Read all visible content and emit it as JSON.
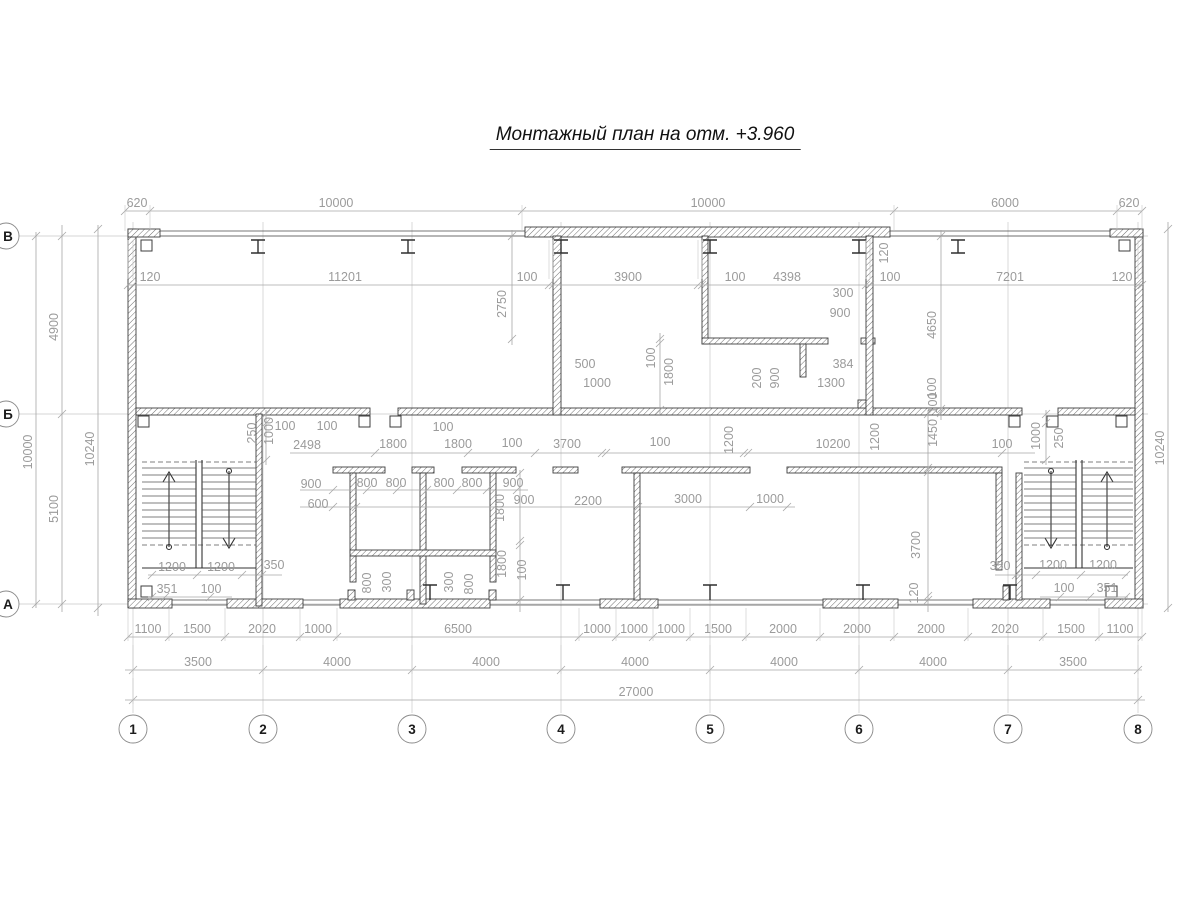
{
  "title": "Монтажный план на отм. +3.960",
  "colors": {
    "wall_line": "#3d3d3d",
    "dimension": "#9b9b9b",
    "grid": "#c9c9c9",
    "background": "#ffffff",
    "title_text": "#111111"
  },
  "axes": {
    "cols": [
      {
        "label": "1",
        "x": 133
      },
      {
        "label": "2",
        "x": 263
      },
      {
        "label": "3",
        "x": 412
      },
      {
        "label": "4",
        "x": 561
      },
      {
        "label": "5",
        "x": 710
      },
      {
        "label": "6",
        "x": 859
      },
      {
        "label": "7",
        "x": 1008
      },
      {
        "label": "8",
        "x": 1138
      }
    ],
    "rows": [
      {
        "label": "В",
        "y": 236
      },
      {
        "label": "Б",
        "y": 414
      },
      {
        "label": "А",
        "y": 604
      }
    ],
    "col_bubble_y": 729,
    "row_bubble_x": 6
  },
  "dim_chains": [
    {
      "o": "h",
      "y": 211,
      "x1": 125,
      "x2": 1142,
      "ticks": [
        125,
        150,
        522,
        894,
        1117,
        1142
      ],
      "g": [
        205,
        231
      ],
      "labels": [
        [
          "620",
          137
        ],
        [
          "10000",
          336
        ],
        [
          "10000",
          708
        ],
        [
          "6000",
          1005
        ],
        [
          "620",
          1129
        ]
      ]
    },
    {
      "o": "h",
      "y": 285,
      "x1": 128,
      "x2": 1142,
      "ticks": [
        128,
        133,
        549,
        553,
        698,
        702,
        866,
        870,
        1138,
        1142
      ],
      "g": [
        279,
        240
      ],
      "labels": [
        [
          "120",
          150
        ],
        [
          "11201",
          345
        ],
        [
          "100",
          527
        ],
        [
          "3900",
          628
        ],
        [
          "100",
          735
        ],
        [
          "4398",
          787
        ],
        [
          "100",
          890
        ],
        [
          "7201",
          1010
        ],
        [
          "120",
          1122
        ]
      ]
    },
    {
      "o": "h",
      "y": 637,
      "x1": 128,
      "x2": 1142,
      "ticks": [
        128,
        169,
        225,
        300,
        337,
        579,
        616,
        653,
        690,
        746,
        820,
        894,
        968,
        1043,
        1099,
        1142
      ],
      "g": [
        608,
        641
      ],
      "labels": [
        [
          "1100",
          148
        ],
        [
          "1500",
          197
        ],
        [
          "2020",
          262
        ],
        [
          "1000",
          318
        ],
        [
          "6500",
          458
        ],
        [
          "1000",
          597
        ],
        [
          "1000",
          634
        ],
        [
          "1000",
          671
        ],
        [
          "1500",
          718
        ],
        [
          "2000",
          783
        ],
        [
          "2000",
          857
        ],
        [
          "2000",
          931
        ],
        [
          "2020",
          1005
        ],
        [
          "1500",
          1071
        ],
        [
          "1100",
          1120
        ]
      ]
    },
    {
      "o": "h",
      "y": 670,
      "x1": 125,
      "x2": 1142,
      "ticks": [
        133,
        263,
        412,
        561,
        710,
        859,
        1008,
        1138
      ],
      "g": [
        645,
        674
      ],
      "labels": [
        [
          "3500",
          198
        ],
        [
          "4000",
          337
        ],
        [
          "4000",
          486
        ],
        [
          "4000",
          635
        ],
        [
          "4000",
          784
        ],
        [
          "4000",
          933
        ],
        [
          "3500",
          1073
        ]
      ]
    },
    {
      "o": "h",
      "y": 700,
      "x1": 125,
      "x2": 1145,
      "ticks": [
        133,
        1138
      ],
      "g": [
        678,
        704
      ],
      "labels": [
        [
          "27000",
          636
        ]
      ]
    },
    {
      "o": "v",
      "x": 36,
      "y1": 232,
      "y2": 608,
      "ticks": [
        236,
        604
      ],
      "labels": [
        [
          "10000",
          452
        ]
      ]
    },
    {
      "o": "v",
      "x": 62,
      "y1": 225,
      "y2": 612,
      "ticks": [
        236,
        414,
        604
      ],
      "labels": [
        [
          "4900",
          327
        ],
        [
          "5100",
          509
        ]
      ]
    },
    {
      "o": "v",
      "x": 98,
      "y1": 225,
      "y2": 616,
      "ticks": [
        229,
        608
      ],
      "labels": [
        [
          "10240",
          449
        ]
      ]
    },
    {
      "o": "v",
      "x": 1168,
      "y1": 222,
      "y2": 612,
      "ticks": [
        229,
        608
      ],
      "labels": [
        [
          "10240",
          448
        ]
      ]
    },
    {
      "o": "h",
      "y": 453,
      "x1": 290,
      "x2": 1035,
      "ticks": [
        375,
        468,
        535,
        602,
        606,
        744,
        748,
        1002
      ],
      "labels": []
    },
    {
      "o": "h",
      "y": 490,
      "x1": 300,
      "x2": 528,
      "ticks": [
        333,
        367,
        397,
        427,
        457,
        487,
        517
      ],
      "labels": []
    },
    {
      "o": "h",
      "y": 507,
      "x1": 300,
      "x2": 795,
      "ticks": [
        333,
        356,
        638,
        750,
        787
      ],
      "labels": []
    },
    {
      "o": "v",
      "x": 520,
      "y1": 470,
      "y2": 612,
      "ticks": [
        473,
        541,
        545,
        600
      ],
      "labels": []
    },
    {
      "o": "v",
      "x": 928,
      "y1": 410,
      "y2": 612,
      "ticks": [
        414,
        468,
        472,
        596,
        600
      ],
      "labels": []
    },
    {
      "o": "v",
      "x": 266,
      "y1": 410,
      "y2": 465,
      "ticks": [
        414,
        423,
        460
      ],
      "labels": []
    },
    {
      "o": "v",
      "x": 1046,
      "y1": 410,
      "y2": 465,
      "ticks": [
        414,
        423,
        460
      ],
      "labels": []
    },
    {
      "o": "v",
      "x": 512,
      "y1": 230,
      "y2": 345,
      "ticks": [
        236,
        339
      ],
      "labels": []
    },
    {
      "o": "v",
      "x": 660,
      "y1": 333,
      "y2": 416,
      "ticks": [
        339,
        343,
        410
      ],
      "labels": []
    },
    {
      "o": "v",
      "x": 941,
      "y1": 230,
      "y2": 420,
      "ticks": [
        236,
        409,
        413
      ],
      "labels": []
    },
    {
      "o": "h",
      "y": 575,
      "x1": 148,
      "x2": 282,
      "ticks": [
        152,
        197,
        242,
        262
      ],
      "labels": []
    },
    {
      "o": "h",
      "y": 597,
      "x1": 148,
      "x2": 232,
      "ticks": [
        152,
        165,
        210
      ],
      "labels": []
    },
    {
      "o": "h",
      "y": 575,
      "x1": 995,
      "x2": 1128,
      "ticks": [
        1016,
        1036,
        1081,
        1126
      ],
      "labels": []
    },
    {
      "o": "h",
      "y": 597,
      "x1": 1040,
      "x2": 1128,
      "ticks": [
        1060,
        1090,
        1126
      ],
      "labels": []
    }
  ],
  "dim_labels": [
    [
      "2750",
      506,
      304,
      1
    ],
    [
      "500",
      585,
      368,
      0
    ],
    [
      "1000",
      597,
      387,
      0
    ],
    [
      "100",
      655,
      358,
      1
    ],
    [
      "1800",
      673,
      372,
      1
    ],
    [
      "300",
      843,
      297,
      0
    ],
    [
      "900",
      840,
      317,
      0
    ],
    [
      "200",
      761,
      378,
      1
    ],
    [
      "900",
      779,
      378,
      1
    ],
    [
      "384",
      843,
      368,
      0
    ],
    [
      "1300",
      831,
      387,
      0
    ],
    [
      "120",
      888,
      253,
      1
    ],
    [
      "4650",
      936,
      325,
      1
    ],
    [
      "100",
      936,
      388,
      1
    ],
    [
      "250",
      256,
      433,
      1
    ],
    [
      "1000",
      273,
      431,
      1
    ],
    [
      "100",
      285,
      430,
      0
    ],
    [
      "100",
      327,
      430,
      0
    ],
    [
      "100",
      443,
      431,
      0
    ],
    [
      "2498",
      307,
      449,
      0
    ],
    [
      "1800",
      393,
      448,
      0
    ],
    [
      "1800",
      458,
      448,
      0
    ],
    [
      "100",
      512,
      447,
      0
    ],
    [
      "3700",
      567,
      448,
      0
    ],
    [
      "100",
      660,
      446,
      0
    ],
    [
      "1200",
      733,
      440,
      1
    ],
    [
      "10200",
      833,
      448,
      0
    ],
    [
      "1200",
      879,
      437,
      1
    ],
    [
      "100",
      937,
      403,
      1
    ],
    [
      "1450",
      937,
      433,
      1
    ],
    [
      "100",
      1002,
      448,
      0
    ],
    [
      "1000",
      1040,
      436,
      1
    ],
    [
      "250",
      1063,
      438,
      1
    ],
    [
      "900",
      311,
      488,
      0
    ],
    [
      "800",
      367,
      487,
      0
    ],
    [
      "800",
      396,
      487,
      0
    ],
    [
      "800",
      444,
      487,
      0
    ],
    [
      "800",
      472,
      487,
      0
    ],
    [
      "900",
      513,
      487,
      0
    ],
    [
      "600",
      318,
      508,
      0
    ],
    [
      "900",
      524,
      504,
      0
    ],
    [
      "2200",
      588,
      505,
      0
    ],
    [
      "3000",
      688,
      503,
      0
    ],
    [
      "1000",
      770,
      503,
      0
    ],
    [
      "800",
      371,
      583,
      1
    ],
    [
      "300",
      391,
      582,
      1
    ],
    [
      "300",
      453,
      582,
      1
    ],
    [
      "800",
      473,
      584,
      1
    ],
    [
      "1800",
      504,
      508,
      1
    ],
    [
      "1800",
      506,
      564,
      1
    ],
    [
      "100",
      526,
      570,
      1
    ],
    [
      "3700",
      920,
      545,
      1
    ],
    [
      "120",
      918,
      593,
      1
    ],
    [
      "350",
      1000,
      570,
      0
    ],
    [
      "1200",
      1053,
      569,
      0
    ],
    [
      "1200",
      1103,
      569,
      0
    ],
    [
      "100",
      1064,
      592,
      0
    ],
    [
      "351",
      1107,
      592,
      0
    ],
    [
      "1200",
      172,
      571,
      0
    ],
    [
      "1200",
      221,
      571,
      0
    ],
    [
      "350",
      274,
      569,
      0
    ],
    [
      "351",
      167,
      593,
      0
    ],
    [
      "100",
      211,
      593,
      0
    ]
  ]
}
